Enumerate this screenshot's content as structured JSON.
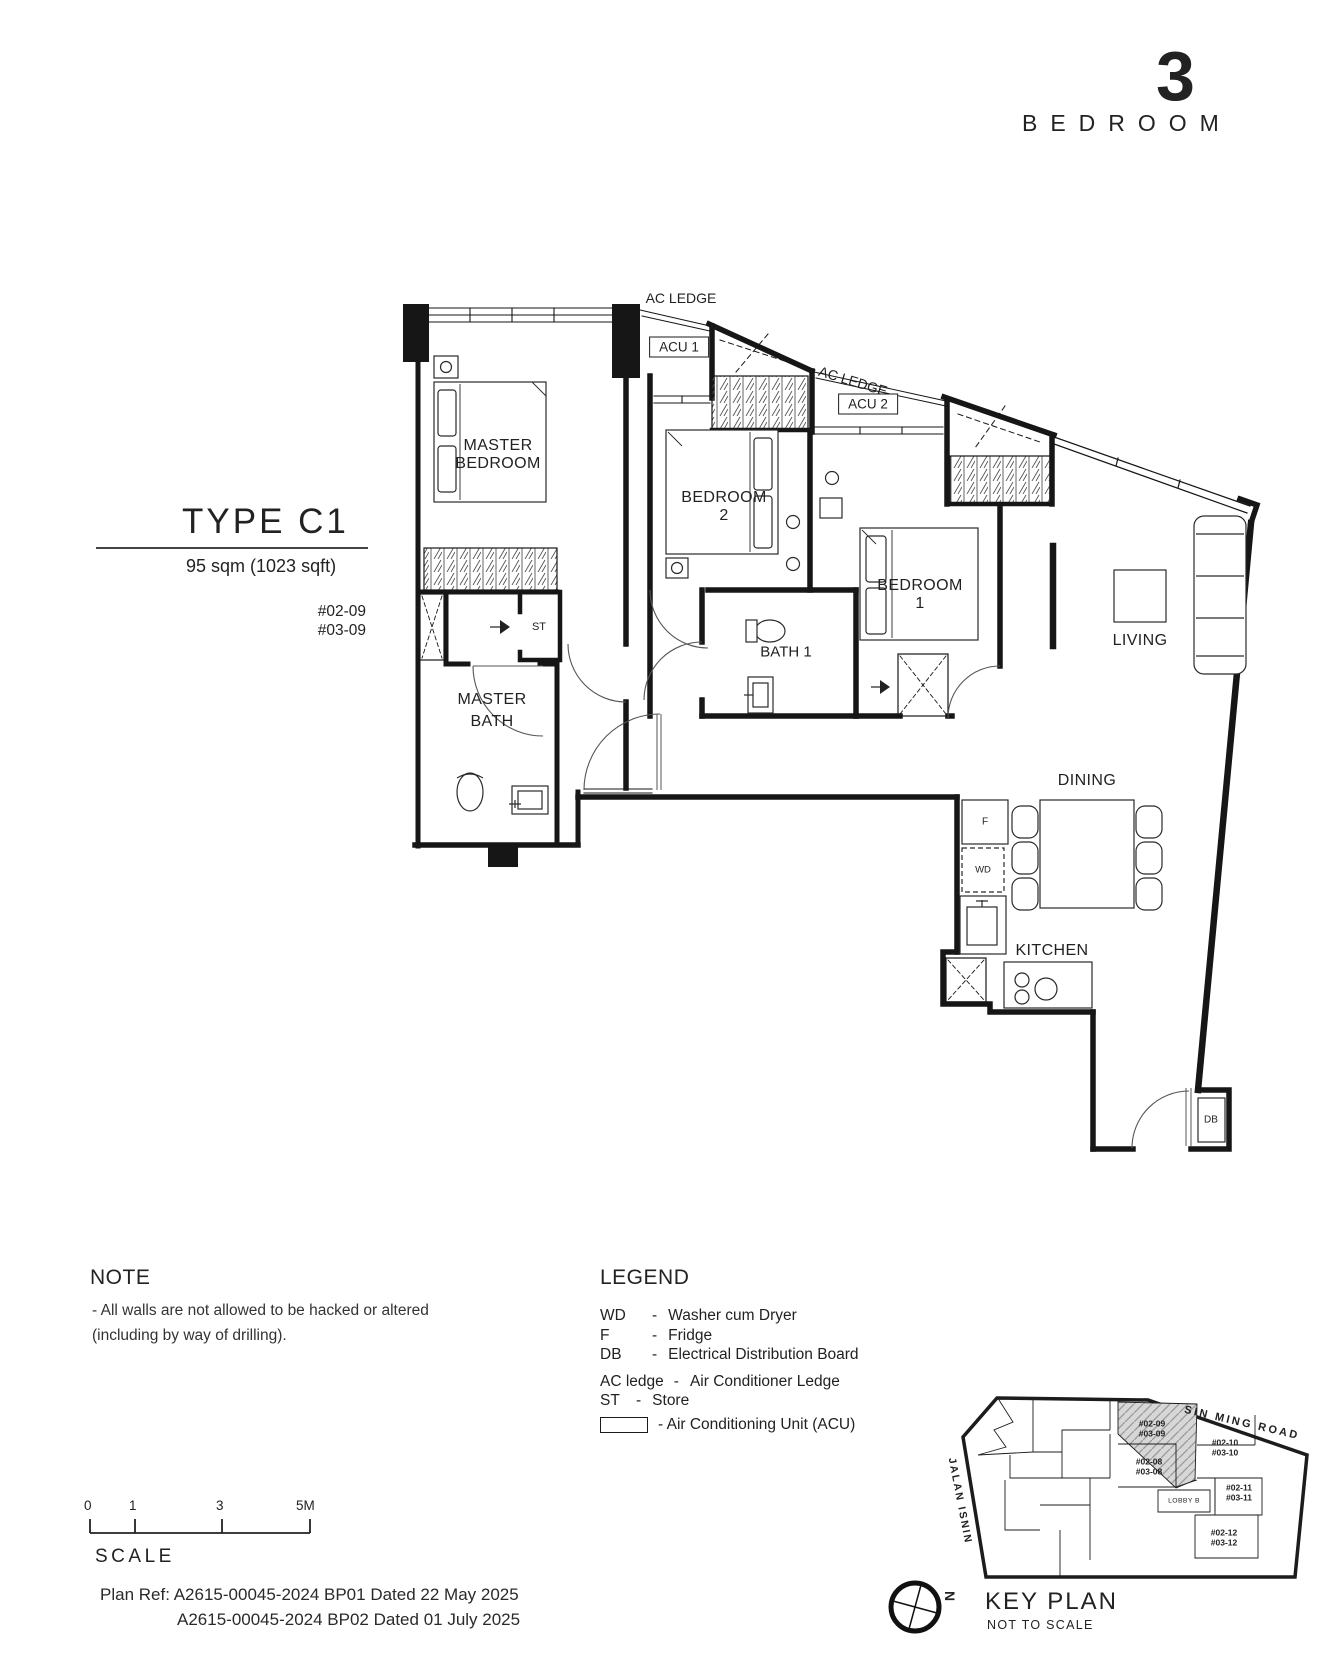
{
  "header": {
    "number": "3",
    "label": "BEDROOM"
  },
  "unit_info": {
    "type": "TYPE C1",
    "area": "95 sqm (1023 sqft)",
    "stack_1": "#02-09",
    "stack_2": "#03-09"
  },
  "plan": {
    "ac_ledge_top": "AC LEDGE",
    "ac_ledge_right": "AC LEDGE",
    "acu1": "ACU 1",
    "acu2": "ACU 2",
    "master_bedroom_1": "MASTER",
    "master_bedroom_2": "BEDROOM",
    "bedroom2_1": "BEDROOM",
    "bedroom2_2": "2",
    "bedroom1_1": "BEDROOM",
    "bedroom1_2": "1",
    "living": "LIVING",
    "bath1": "BATH 1",
    "master_bath_1": "MASTER",
    "master_bath_2": "BATH",
    "st": "ST",
    "dining": "DINING",
    "kitchen": "KITCHEN",
    "fridge": "F",
    "washer": "WD",
    "db": "DB"
  },
  "note": {
    "heading": "NOTE",
    "line1": "-  All walls are not allowed to be hacked or altered",
    "line2": "(including by way of drilling)."
  },
  "legend": {
    "heading": "LEGEND",
    "items": [
      {
        "abbr": "WD",
        "dash": "-",
        "desc": "Washer cum Dryer"
      },
      {
        "abbr": "F",
        "dash": "-",
        "desc": "Fridge"
      },
      {
        "abbr": "DB",
        "dash": "-",
        "desc": "Electrical Distribution Board"
      },
      {
        "abbr": "AC ledge",
        "dash": "-",
        "desc": "Air Conditioner Ledge"
      },
      {
        "abbr": "ST",
        "dash": "-",
        "desc": "Store"
      }
    ],
    "acu_desc": "- Air Conditioning Unit (ACU)"
  },
  "scale_bar": {
    "t0": "0",
    "t1": "1",
    "t3": "3",
    "t5": "5M",
    "label": "SCALE"
  },
  "plan_ref": {
    "line1": "Plan Ref: A2615-00045-2024 BP01 Dated 22 May 2025",
    "line2": "A2615-00045-2024 BP02 Dated 01 July 2025"
  },
  "key_plan": {
    "heading": "KEY PLAN",
    "subheading": "NOT TO SCALE",
    "north": "N",
    "road_top": "SIN MING ROAD",
    "road_left": "JALAN ISNIN",
    "lobby": "LOBBY B",
    "units": [
      {
        "l1": "#02-09",
        "l2": "#03-09"
      },
      {
        "l1": "#02-10",
        "l2": "#03-10"
      },
      {
        "l1": "#02-08",
        "l2": "#03-08"
      },
      {
        "l1": "#02-11",
        "l2": "#03-11"
      },
      {
        "l1": "#02-12",
        "l2": "#03-12"
      }
    ]
  },
  "colors": {
    "line": "#1a1a1a",
    "highlight_fill": "#d7d7d7"
  }
}
